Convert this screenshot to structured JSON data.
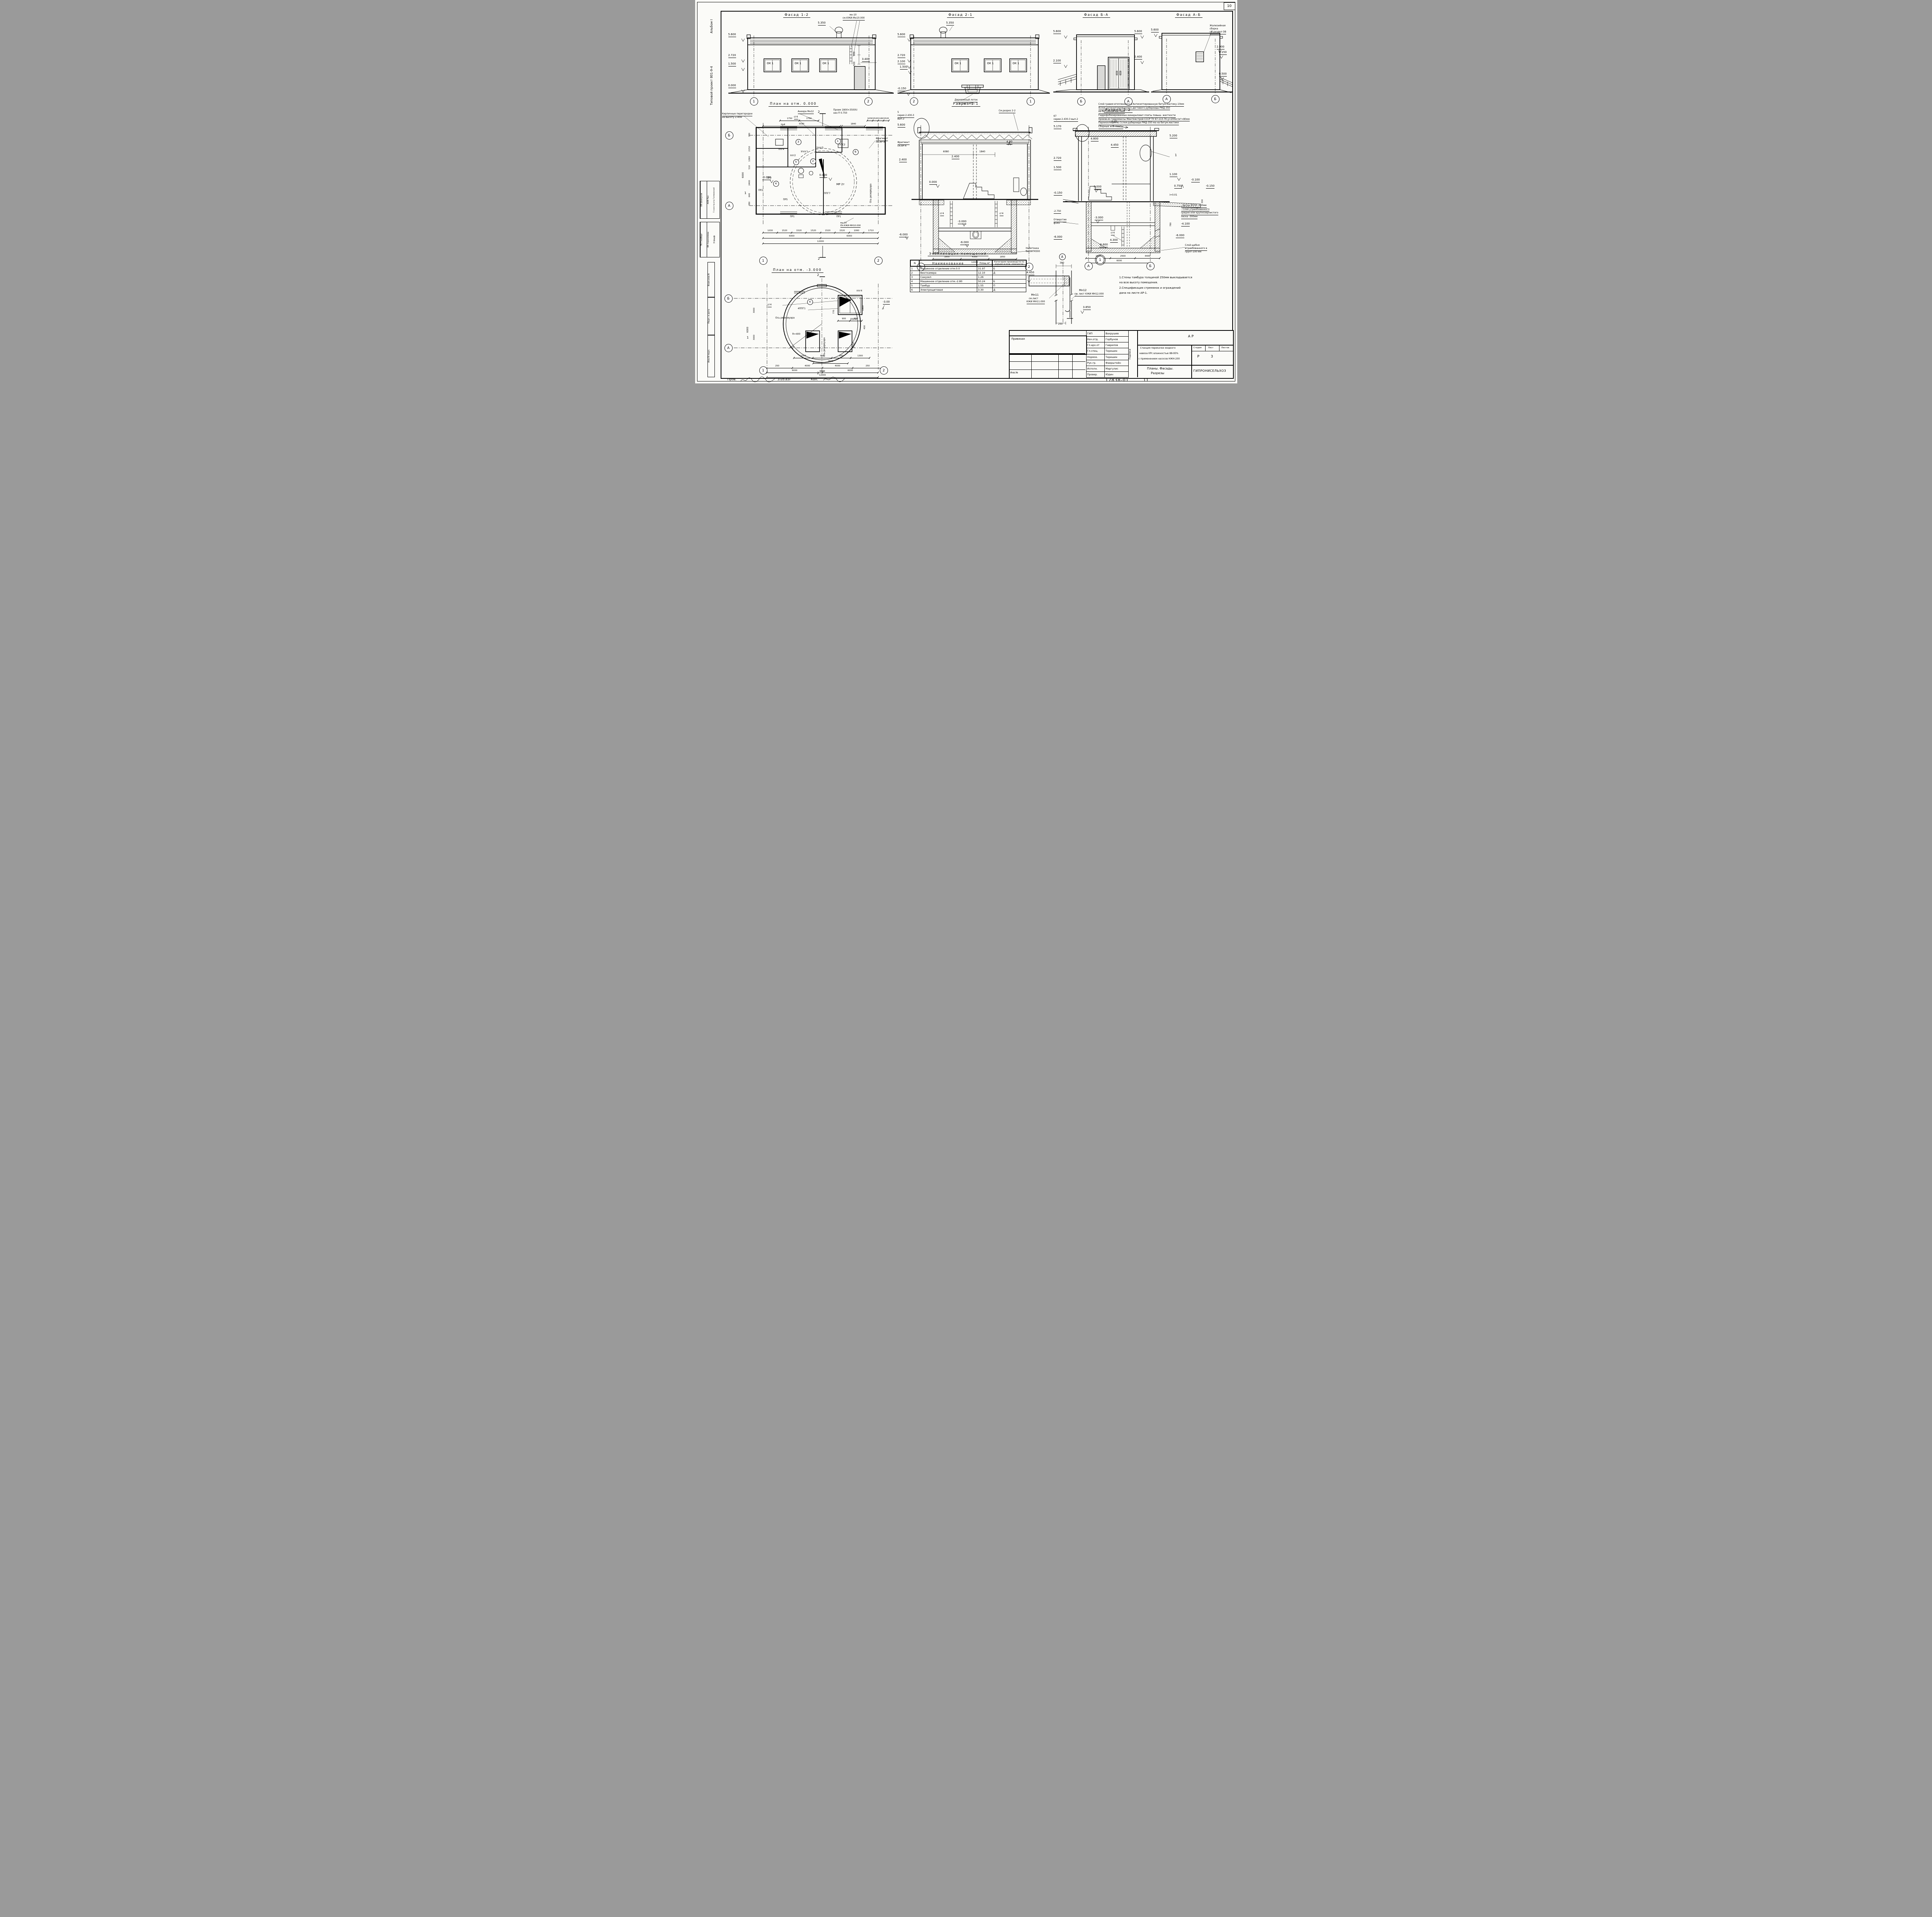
{
  "sheet": {
    "corner_number": "10",
    "doc_number": "17838-01",
    "doc_sheet": "11",
    "footer_prov": "Пров.",
    "footer_date": "3.05.83г",
    "footer_kop": "Коп."
  },
  "margin": {
    "project": "Типовой проект 801-9-4",
    "album": "Альбом I",
    "signs_a": [
      "ОВ  Шевкунов",
      "АОВ  Паз",
      "Гл.констр.отд  Голяковский"
    ],
    "signs_b": [
      "ТК  Глейберг",
      "ВК  Сорокомова",
      "Э  Шарф"
    ],
    "blocks": [
      "Взам.инв.N",
      "Подп. и дата",
      "Инв.N подл."
    ]
  },
  "facade12": {
    "title": "Фасад 1-2",
    "window": "ОК 1",
    "e5600": "5.600",
    "e2720": "2.720",
    "e1500": "1.500",
    "e0000": "0.000",
    "etop": "5.350",
    "note1": "мн-10",
    "note2": "см.КЖИ-Мн10.000",
    "d800": "800",
    "d500": "500",
    "d3400": "3.400",
    "ax1": "1",
    "ax2": "2"
  },
  "facade21": {
    "title": "Фасад 2-1",
    "window": "ОК 1",
    "e5600": "5.600",
    "e2720": "2.720",
    "e2100": "2.100",
    "e1500": "1.500",
    "em0150": "-0.150",
    "etop": "5.350",
    "note1": "Деревянный лоток",
    "note2": "см. лист АР-5",
    "ax2": "2",
    "ax1": "1"
  },
  "facadeBA": {
    "title": "Фасад Б-А",
    "e5600l": "5.600",
    "e2100": "2.100",
    "e5600r": "5.600",
    "e2400": "2.400",
    "axb": "Б",
    "axa": "А"
  },
  "facadeAB": {
    "title": "Фасад А-Б",
    "e5600": "5.600",
    "e2900": "2.900",
    "e2150": "2.150",
    "e0500": "0.500",
    "note1": "Жалюзийная",
    "note2": "сборка",
    "note3": "см.раздел ОВ",
    "axa": "А",
    "axb": "Б"
  },
  "roof_layers": [
    "Слой гравия втопленного в Антисептированную битум.мастику-10мм",
    "4слоя антисептированного дегтевого рубероида РМД-350",
    "на битумной мастике",
    "Гидрофобизированные минераловат.плиты повыш. жесткости",
    "произв.из гидромассы Минтяжстрой СССР ТУ 67-113-76 ɣ=200кг/м³=80мм",
    "Пароизоляция из 1слоя рубероида РМД-350 ма на битум.мастике",
    "Сборные ж.б. плиты"
  ],
  "plan0": {
    "title": "План на отм. 0.000",
    "np1": "Кирпичные перегородки",
    "np2": "на высоту 2.40м",
    "anchor": "Анкера Мн12",
    "sg": "сг4",
    "op1": "Проем 1800×350(h)",
    "op2": "низ ∇ 0.750",
    "fr1": "Фрагмент",
    "fr2": "см.АР-4",
    "mn1": "мн-10",
    "mn2": "см.КЖИ-МН10.000",
    "mr": "МР 2т",
    "osr": "Ось резервуара",
    "e0": "0.000",
    "em002": "-0.020",
    "dt1": [
      "1750",
      "1750"
    ],
    "dt2": [
      "5590"
    ],
    "dt3": [
      "1840"
    ],
    "dt4": [
      "1030",
      "1520",
      "1160",
      "1520"
    ],
    "db1": [
      "1030",
      "1520",
      "1520",
      "1520",
      "1520",
      "1520",
      "1060",
      "1710"
    ],
    "db2": [
      "6000",
      "6000"
    ],
    "db3": [
      "12000"
    ],
    "dl": [
      "380",
      "2150",
      "1060",
      "510",
      "2400",
      "640",
      "380"
    ],
    "dlt": "6000",
    "pr1a": "ПР1",
    "pr1b": "ПР1",
    "pr2": "ПР2",
    "pr3": "ПР3",
    "pr5": "ПР5",
    "pr4": "пр4",
    "ppg7": "ППГ7",
    "pps2": "ППС2",
    "uppg1": "Уппг1",
    "ppg2": "ппг2",
    "ppg4": "ппг4",
    "ppg5": "2ппг5",
    "r1": "1",
    "r2": "2",
    "r3": "3",
    "r4": "4",
    "r5": "5",
    "r6": "6",
    "axb": "Б",
    "axa": "А",
    "ax1": "1",
    "ax2": "2",
    "s2": "2",
    "s1": "1"
  },
  "sec11": {
    "title": "Разрез 1-1",
    "see": "См.разрез 2-2",
    "ser1": "5",
    "ser2": "серия 2.430-3",
    "ser3": "вып.2",
    "e5600": "5.600",
    "e2400a": "2.400",
    "e2400b": "2.400",
    "e0": "0.000",
    "e480": "4.80",
    "fr1": "Фрагмент",
    "fr2": "см.АР-4",
    "d6080": "6080",
    "d1840": "1840",
    "sgl": "сг4",
    "sgr": "сг4",
    "em3": "-3.000",
    "em6a": "-6.000",
    "em6b": "-6.000",
    "nab1": "Набетонка",
    "nab2": "бетон М300",
    "db": [
      "1850",
      "4300",
      "1850"
    ],
    "dbt": [
      "12000"
    ],
    "ax1": "1",
    "ax2": "2"
  },
  "sec22": {
    "title": "Разрез 2-2",
    "ser1": "67",
    "ser2": "серии 2.430-3 вып.2",
    "e5170": "5.170",
    "s001": "0.01",
    "e4800": "4.800",
    "e4450": "4.450",
    "e5200": "5.200",
    "e2720": "2.720",
    "e1500": "1.500",
    "e0": "0.000",
    "em015": "-0.150",
    "det": "1",
    "e1100": "1.100",
    "em0100": "-0.100",
    "e0750": "0.750",
    "slope": "i=0.01",
    "em0150": "-0.150",
    "d300": "300",
    "floor": [
      "- Бетон М150          -100мм",
      "- Слой утрамбованного",
      "средне или крупнозернистого",
      "песка              -300мм"
    ],
    "hole1": "Отверстие",
    "hole2": "ф165",
    "em2750": "-2.750",
    "em3000": "-3.000",
    "sg": "сг4",
    "e4300": "4.300",
    "em4100": "-4.100",
    "d780": "780",
    "em6000a": "-6.000",
    "em6000b": "-6.000",
    "em6600": "-6.600",
    "sch1": "Слой щебня",
    "sch2": "втрамбованного в",
    "sch3": "грунт-100 мм",
    "db": [
      "1100",
      "2500",
      "4400"
    ],
    "dbt": [
      "6000"
    ],
    "axa": "А",
    "axb": "Б"
  },
  "plan3": {
    "title": "План на отм. -3.000",
    "sg": "сг4",
    "ppg1": "4ППГ1",
    "ppg4a": "ппг4",
    "ppg4b": "ППГ4",
    "em3": "-3.00",
    "rad": "R=400",
    "osr1": "Ось резервуара",
    "osr2": "Ось резервуара",
    "room": "4",
    "d900": [
      "900",
      "900"
    ],
    "d1800": "1800",
    "d770": "770",
    "d400": "400",
    "dm": [
      "1300",
      "850",
      "850",
      "1300"
    ],
    "d2500": "2500",
    "d2600": [
      "2600"
    ],
    "db1": [
      "250",
      "4000",
      "4000",
      "250"
    ],
    "db2": [
      "6000",
      "6000"
    ],
    "db3": [
      "12000"
    ],
    "dl1": "3000",
    "dl2": "3000",
    "dlt": "6000",
    "axb": "Б",
    "axa": "А",
    "s1": "1",
    "s2": "2",
    "b1": "1",
    "b2": "2"
  },
  "explication": {
    "title": "Экспликация помещений",
    "hn": "N",
    "hname": "Наименование",
    "harea": "Площ м²",
    "hcat": "Категория производств по взрыво и пож. опасности",
    "rows": [
      {
        "n": "1",
        "name": "Машинное отделение отм.0.0",
        "area": "31.97",
        "cat": "Б"
      },
      {
        "n": "2",
        "name": "Венткамера",
        "area": "12.10",
        "cat": "Д"
      },
      {
        "n": "3",
        "name": "Санузел",
        "area": "1.26",
        "cat": ""
      },
      {
        "n": "4",
        "name": "Машинное отделение отм.-2.80",
        "area": "50.24",
        "cat": "Б"
      },
      {
        "n": "5",
        "name": "Тамбур",
        "area": "1.55",
        "cat": "П"
      },
      {
        "n": "6",
        "name": "Электрощитовая",
        "area": "3.30",
        "cat": "Д"
      }
    ]
  },
  "notes": [
    "1.Стены тамбура толщиной 250мм выкладывается",
    "на всю высоту помещения.",
    "2.Спецификация стремянок и ограждений",
    "дана на листе АР-1."
  ],
  "detail": {
    "d380": "380",
    "e4450": "4.450",
    "mn11a": "Мн11",
    "mn11b": "см.лист",
    "mn11c": "КЖИ МН11.000",
    "mn12a": "Мн12",
    "mn12b": "см. лист КЖИ МН12.000",
    "e3850": "3.850",
    "d250": "250",
    "axa": "А",
    "b1": "1"
  },
  "titleblock": {
    "privyazan": "Привязан",
    "inv": "Инв.№",
    "podpisi": "Подписи",
    "code": "АР",
    "rows": [
      {
        "role": "ГИП",
        "name": "Вахрушев"
      },
      {
        "role": "Нач.отд.",
        "name": "Горбунов"
      },
      {
        "role": "Гл.арх.от",
        "name": "Гаврилов"
      },
      {
        "role": "Гл.спец.",
        "name": "Терешин"
      },
      {
        "role": "Нормок.",
        "name": "Терешин"
      },
      {
        "role": "Рук.гр.",
        "name": "Фаерштейн"
      },
      {
        "role": "Исполн.",
        "name": "Маргулис"
      },
      {
        "role": "Провер.",
        "name": "Юдин"
      }
    ],
    "obj1": "Станция перекачки жидкого",
    "obj2": "навоза КРс влажностью 88-95%",
    "obj3": "с применением насосов НЖН-200",
    "stage_h": "Стадия",
    "sheet_h": "Лист",
    "sheets_h": "Листов",
    "stage": "Р",
    "sheet": "3",
    "sheets": "",
    "cont1": "Планы. Фасады.",
    "cont2": "Разрезы",
    "org": "ГИПРОНИСЕЛЬХОЗ"
  }
}
